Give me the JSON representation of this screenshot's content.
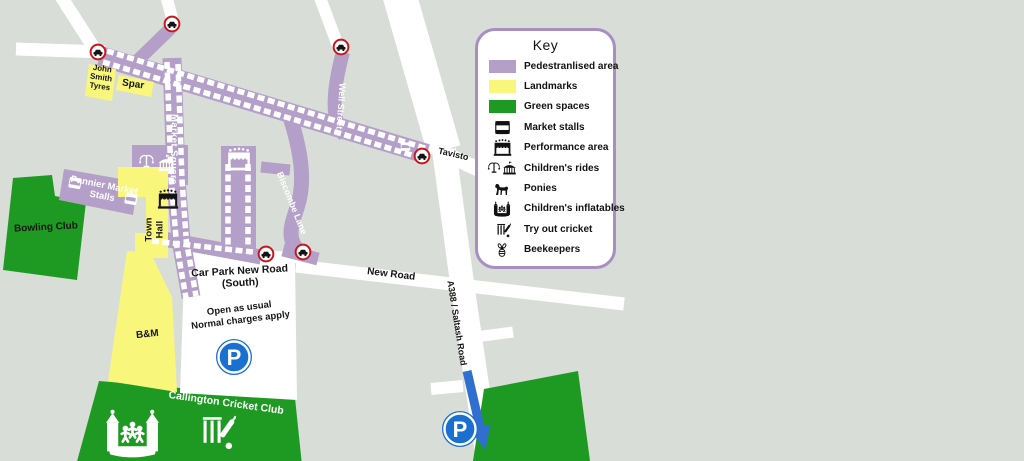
{
  "colors": {
    "background": "#d8ddd8",
    "pedestrianised_purple": "#b49fc8",
    "landmark_yellow": "#f9f77b",
    "green_space": "#1e9a23",
    "road_white": "#ffffff",
    "key_border_purple": "#a78fc2",
    "no_vehicle_sign_red": "#c8161d",
    "parking_blue": "#1a70d0"
  },
  "key": {
    "title": "Key",
    "items": [
      {
        "label": "Pedestranlised area",
        "swatch": "purple"
      },
      {
        "label": "Landmarks",
        "swatch": "yellow"
      },
      {
        "label": "Green spaces",
        "swatch": "green"
      },
      {
        "label": "Market stalls",
        "icon": "market-stall"
      },
      {
        "label": "Performance area",
        "icon": "performance-area"
      },
      {
        "label": "Children's rides",
        "icon": "swing-ride-and-carousel"
      },
      {
        "label": "Ponies",
        "icon": "pony"
      },
      {
        "label": "Children's inflatables",
        "icon": "bouncy-castle"
      },
      {
        "label": "Try out cricket",
        "icon": "cricket"
      },
      {
        "label": "Beekeepers",
        "icon": "bee"
      }
    ]
  },
  "map": {
    "labels": {
      "john_smith_tyres": "John\nSmith\nTyres",
      "spar": "Spar",
      "market_square": "Market Square",
      "well_street": "Well Street",
      "biscombe_lane": "Biscombe Lane",
      "pannier_market": "Pannier Market\nStalls",
      "town_hall": "Town\nHall",
      "bowling_club": "Bowling Club",
      "bm": "B&M",
      "car_park_title": "Car Park New Road\n(South)",
      "car_park_note": "Open as usual\nNormal charges apply",
      "new_road": "New Road",
      "tavistock": "Tavisto",
      "a388": "A388 / Saltash Road",
      "cricket_club": "Callington Cricket Club",
      "parking_letter": "P"
    }
  }
}
